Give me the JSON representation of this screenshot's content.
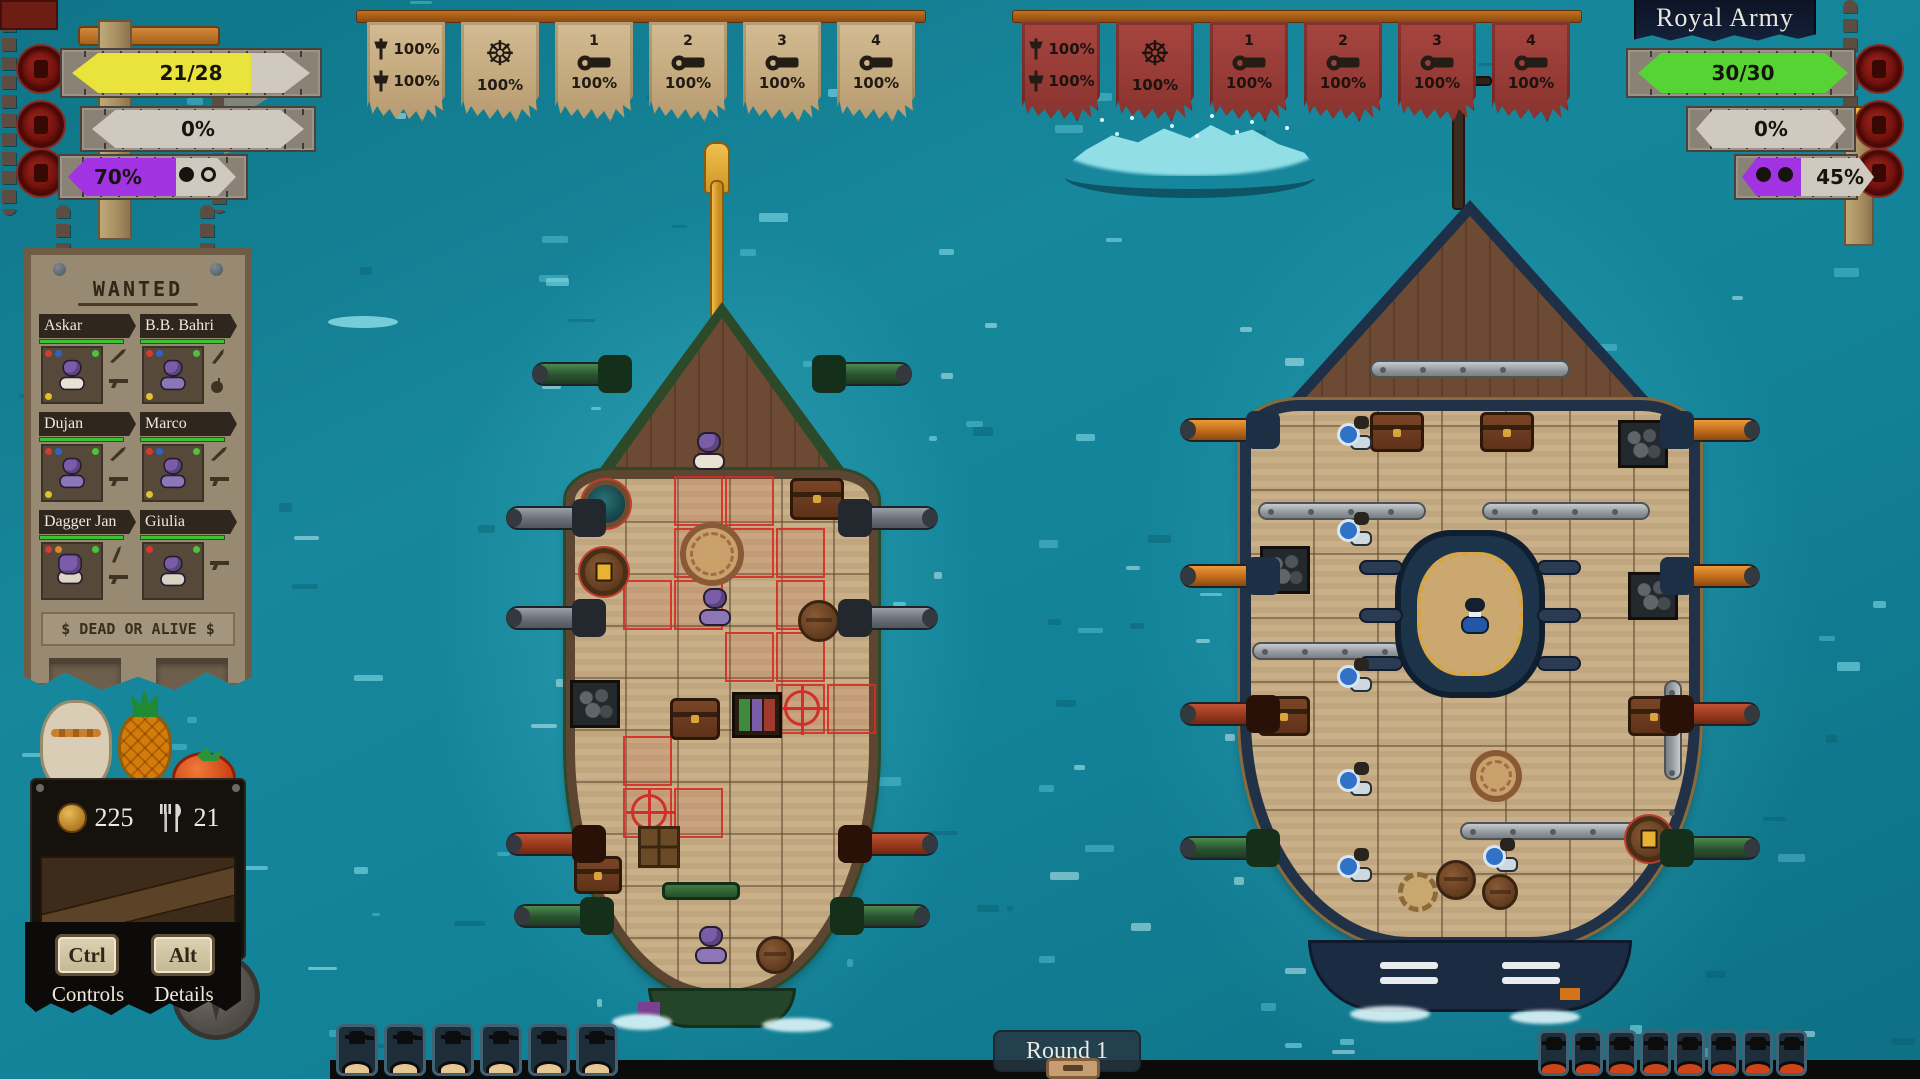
{
  "scene": {
    "round_label": "Round 1"
  },
  "player_hud": {
    "bars": [
      {
        "name": "hull-integrity",
        "value": "21/28",
        "fill_pct": 75,
        "fill_color": "#e9e33b"
      },
      {
        "name": "sail-damage",
        "value": "0%",
        "fill_pct": 0,
        "fill_color": "#cfc9bf"
      },
      {
        "name": "boarding-charge",
        "value": "70%",
        "fill_pct": 70,
        "fill_color": "#a233e2",
        "pips_filled": 1,
        "pips_total": 2
      }
    ],
    "banners": [
      {
        "icon": "sails-icon",
        "rows": [
          "100%",
          "100%"
        ]
      },
      {
        "icon": "helm-icon",
        "label": "100%"
      },
      {
        "icon": "cannon-icon",
        "number": "1",
        "label": "100%"
      },
      {
        "icon": "cannon-icon",
        "number": "2",
        "label": "100%"
      },
      {
        "icon": "cannon-icon",
        "number": "3",
        "label": "100%"
      },
      {
        "icon": "cannon-icon",
        "number": "4",
        "label": "100%"
      }
    ],
    "crew_slot_count": 6
  },
  "enemy_hud": {
    "title": "Royal Army",
    "bars": [
      {
        "name": "hull-integrity",
        "value": "30/30",
        "fill_pct": 100,
        "fill_color": "#55d433"
      },
      {
        "name": "sail-damage",
        "value": "0%",
        "fill_pct": 0,
        "fill_color": "#cfc9bf"
      },
      {
        "name": "boarding-charge",
        "value": "45%",
        "fill_pct": 45,
        "fill_color": "#a233e2",
        "pips_filled": 2,
        "pips_total": 2
      }
    ],
    "banners": [
      {
        "icon": "sails-icon",
        "rows": [
          "100%",
          "100%"
        ]
      },
      {
        "icon": "helm-icon",
        "label": "100%"
      },
      {
        "icon": "cannon-icon",
        "number": "1",
        "label": "100%"
      },
      {
        "icon": "cannon-icon",
        "number": "2",
        "label": "100%"
      },
      {
        "icon": "cannon-icon",
        "number": "3",
        "label": "100%"
      },
      {
        "icon": "cannon-icon",
        "number": "4",
        "label": "100%"
      }
    ],
    "crew_slot_count": 8
  },
  "wanted_poster": {
    "title": "WANTED",
    "crew": [
      {
        "name": "Askar"
      },
      {
        "name": "B.B. Bahri"
      },
      {
        "name": "Dujan"
      },
      {
        "name": "Marco"
      },
      {
        "name": "Dagger Jan"
      },
      {
        "name": "Giulia"
      }
    ],
    "footer": "$ DEAD OR ALIVE $"
  },
  "resources": {
    "coins": "225",
    "food": "21"
  },
  "controls": [
    {
      "key": "Ctrl",
      "label": "Controls"
    },
    {
      "key": "Alt",
      "label": "Details"
    }
  ]
}
